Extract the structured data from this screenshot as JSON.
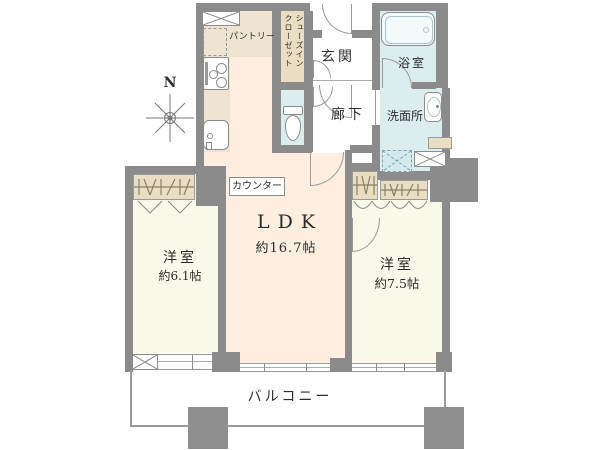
{
  "colors": {
    "wall": "#8b8b8b",
    "floor_ldk": "#fdeee0",
    "floor_room": "#faf8e9",
    "floor_wet": "#dcedf0",
    "floor_closet": "#e9ddc2",
    "floor_kitchen_counter": "#efe4d2",
    "outline": "#999999",
    "text": "#2b2b2b"
  },
  "compass": {
    "north_label": "N"
  },
  "rooms": {
    "pantry": {
      "label": "パントリー"
    },
    "shoes_closet": {
      "label": "シューズイン\nクローゼット"
    },
    "entrance": {
      "label": "玄関"
    },
    "bathroom": {
      "label": "浴室"
    },
    "hallway": {
      "label": "廊下"
    },
    "washroom": {
      "label": "洗面所"
    },
    "counter": {
      "label": "カウンター"
    },
    "ldk": {
      "label": "LDK",
      "size": "約16.7帖"
    },
    "bedroom_left": {
      "label": "洋室",
      "size": "約6.1帖"
    },
    "bedroom_right": {
      "label": "洋室",
      "size": "約7.5帖"
    },
    "balcony": {
      "label": "バルコニー"
    }
  }
}
